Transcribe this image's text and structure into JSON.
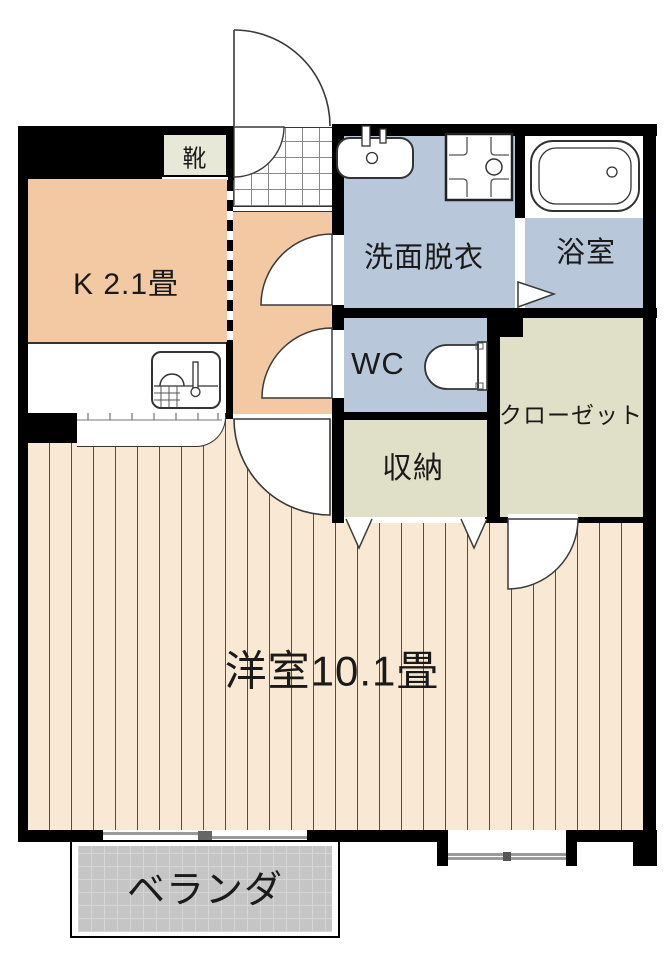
{
  "floorplan": {
    "rooms": {
      "shoe_cabinet": {
        "label": "靴"
      },
      "kitchen": {
        "label": "K 2.1畳"
      },
      "washroom": {
        "label": "洗面脱衣"
      },
      "bathroom": {
        "label": "浴室"
      },
      "wc": {
        "label": "WC"
      },
      "closet": {
        "label": "クローゼット"
      },
      "storage": {
        "label": "収納"
      },
      "main_room": {
        "label": "洋室10.1畳"
      },
      "veranda": {
        "label": "ベランダ"
      }
    },
    "colors": {
      "wall": "#000000",
      "wood_floor": "#f9e8d4",
      "plank_line": "#4f4f4f",
      "kitchen_floor": "#f2c9a2",
      "wet_area_floor": "#b8c7da",
      "closet_floor": "#e0dfc7",
      "shoe_cabinet_fill": "#e8e8d8",
      "entrance_tile": "#ffffff",
      "veranda_floor": "#c5c5c5"
    }
  }
}
